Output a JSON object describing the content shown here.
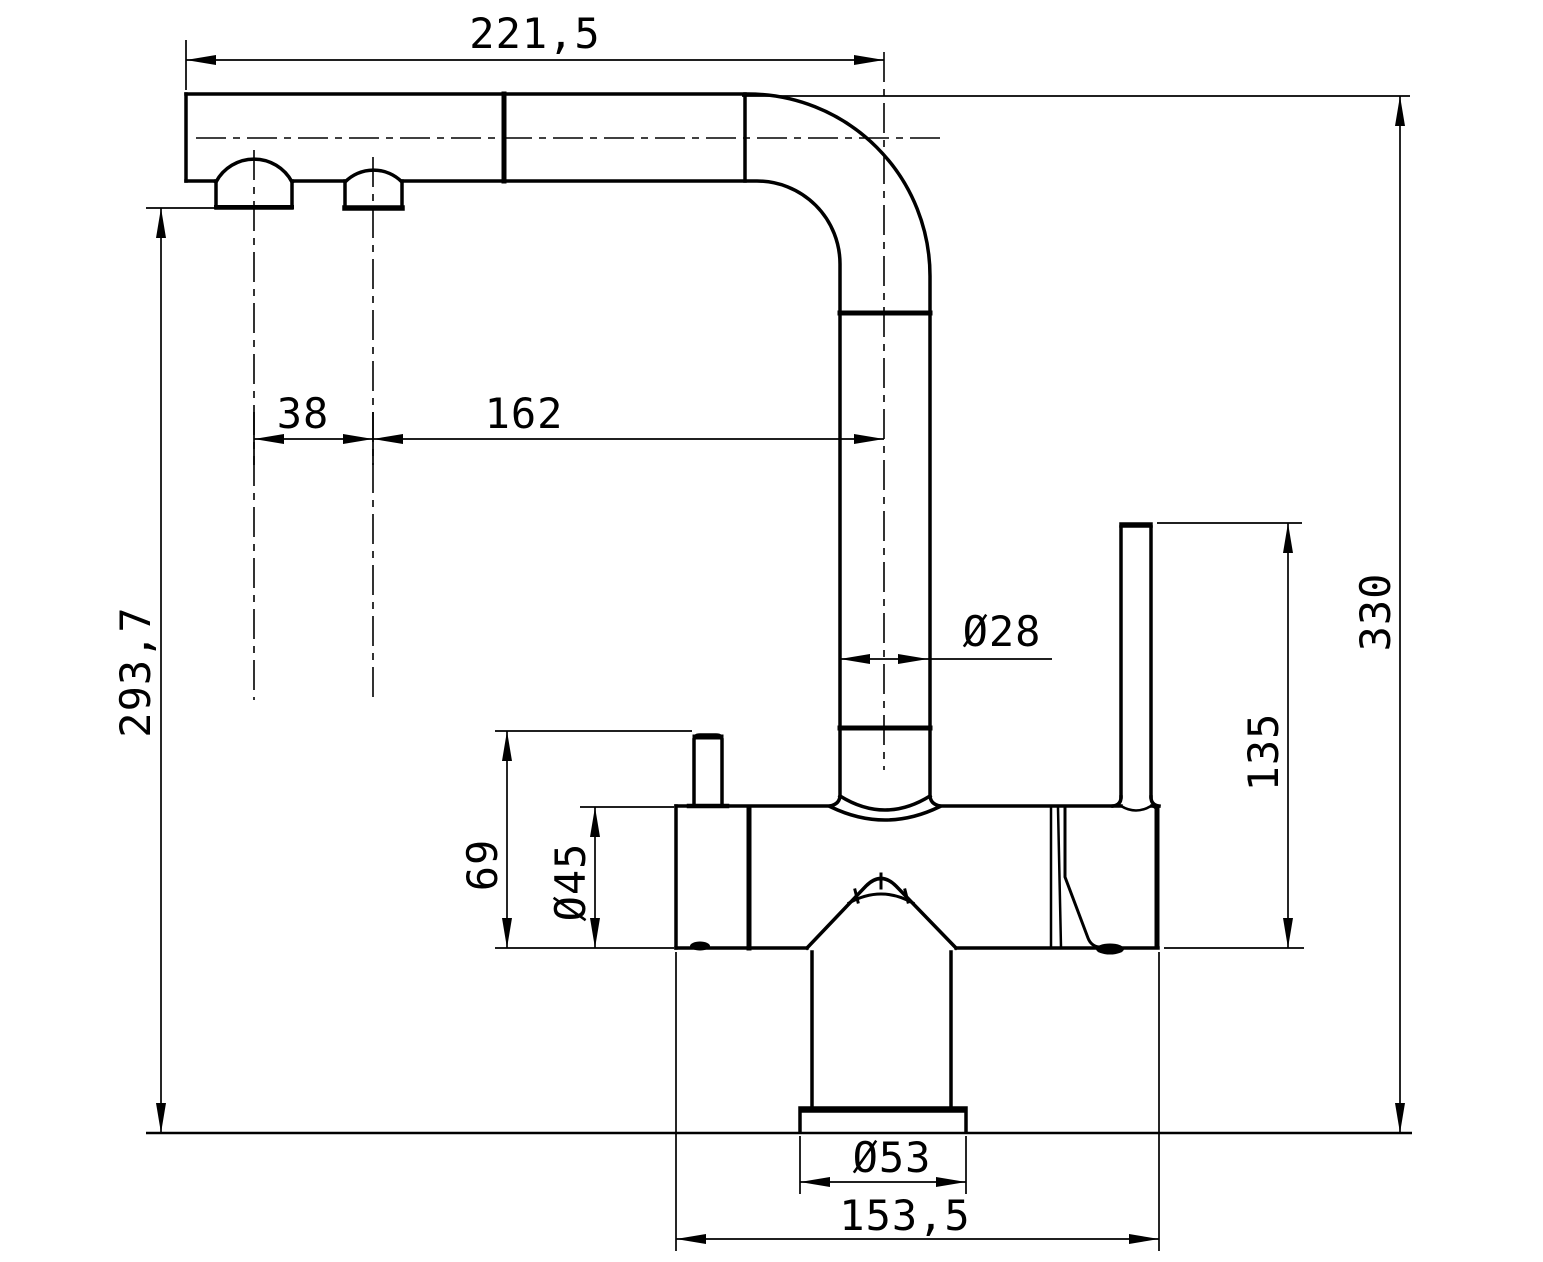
{
  "drawing": {
    "subject": "Kitchen faucet - dimensioned side elevation",
    "units": "mm",
    "line_color": "#000000",
    "background_color": "#ffffff",
    "dimensions": {
      "spout_reach": {
        "label": "221,5",
        "value": 221.5,
        "orientation": "horizontal"
      },
      "aerator_spacing": {
        "label": "38",
        "value": 38,
        "orientation": "horizontal"
      },
      "aerator_to_riser": {
        "label": "162",
        "value": 162,
        "orientation": "horizontal"
      },
      "outlet_height": {
        "label": "293,7",
        "value": 293.7,
        "orientation": "vertical"
      },
      "overall_height": {
        "label": "330",
        "value": 330,
        "orientation": "vertical"
      },
      "spout_tube_diameter": {
        "label": "Ø28",
        "value": 28,
        "orientation": "horizontal"
      },
      "handle_height": {
        "label": "135",
        "value": 135,
        "orientation": "vertical"
      },
      "side_pin_height": {
        "label": "69",
        "value": 69,
        "orientation": "vertical"
      },
      "body_diameter": {
        "label": "Ø45",
        "value": 45,
        "orientation": "vertical"
      },
      "base_diameter": {
        "label": "Ø53",
        "value": 53,
        "orientation": "horizontal"
      },
      "body_length": {
        "label": "153,5",
        "value": 153.5,
        "orientation": "horizontal"
      }
    }
  }
}
